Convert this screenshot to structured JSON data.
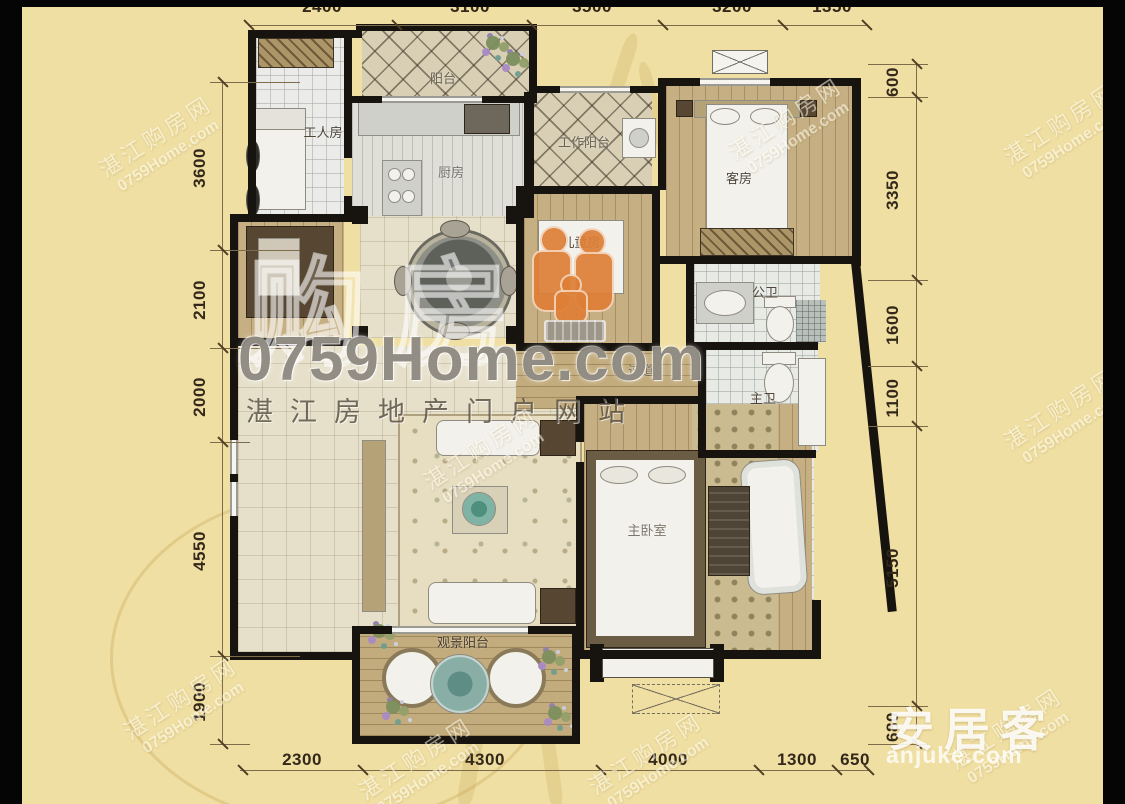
{
  "branding": {
    "watermark_cn_large": "购房",
    "watermark_site": "0759Home.com",
    "watermark_tagline": "湛江房地产门户网站",
    "tile_watermark_line1": "湛江购房网",
    "tile_watermark_line2": "0759Home.com",
    "anjuke_logo_cn": "安居客",
    "anjuke_logo_en": "anjuke.com"
  },
  "rooms": [
    {
      "id": "worker-room",
      "label": "工人房"
    },
    {
      "id": "balcony",
      "label": "阳台"
    },
    {
      "id": "kitchen",
      "label": "厨房"
    },
    {
      "id": "work-balcony",
      "label": "工作阳台"
    },
    {
      "id": "guest-room",
      "label": "客房"
    },
    {
      "id": "kids-room",
      "label": "儿童房"
    },
    {
      "id": "public-bath",
      "label": "公卫"
    },
    {
      "id": "hallway",
      "label": "过道"
    },
    {
      "id": "master-bath",
      "label": "主卫"
    },
    {
      "id": "master-bedroom",
      "label": "主卧室"
    },
    {
      "id": "view-balcony",
      "label": "观景阳台"
    }
  ],
  "dimensions_mm": {
    "top": [
      "2400",
      "3100",
      "3500",
      "3200",
      "1350"
    ],
    "left": [
      "3600",
      "2100",
      "2000",
      "4550",
      "1900"
    ],
    "right": [
      "600",
      "3350",
      "1600",
      "1100",
      "5150",
      "680"
    ],
    "bottom": [
      "2300",
      "4300",
      "4000",
      "1300",
      "650"
    ]
  },
  "colors": {
    "background": "#f0dfa2",
    "frame": "#050505",
    "wall": "#17130e",
    "dimension_text": "#33281a",
    "logo_orange": "#de7f36",
    "watermark_white": "#fffdf2"
  }
}
